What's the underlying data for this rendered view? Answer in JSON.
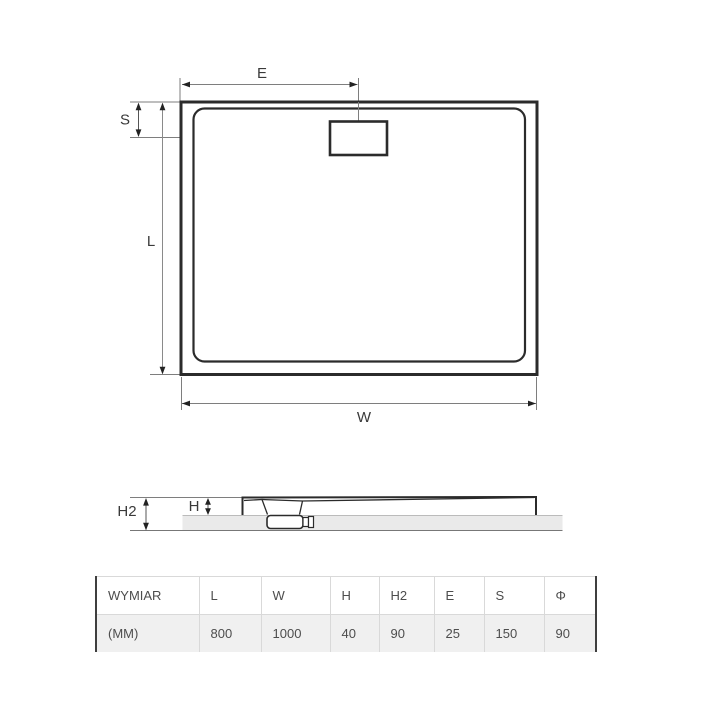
{
  "diagram": {
    "top_view": {
      "dim_e_label": "E",
      "dim_s_label": "S",
      "dim_l_label": "L",
      "dim_w_label": "W"
    },
    "side_view": {
      "dim_h_label": "H",
      "dim_h2_label": "H2"
    }
  },
  "table": {
    "headers": [
      "WYMIAR",
      "L",
      "W",
      "H",
      "H2",
      "E",
      "S",
      "Φ"
    ],
    "values_row": [
      "(MM)",
      "800",
      "1000",
      "40",
      "90",
      "25",
      "150",
      "90"
    ]
  },
  "colors": {
    "line_dark": "#2b2b2b",
    "dim_line": "#7e7e7e",
    "arrow": "#222222",
    "floor_band": "#eaeaea",
    "table_border_dark": "#3f3f3f",
    "table_border_light": "#d9d9d9",
    "table_row_bg": "#f0f0f0",
    "text": "#4d4d4d"
  }
}
